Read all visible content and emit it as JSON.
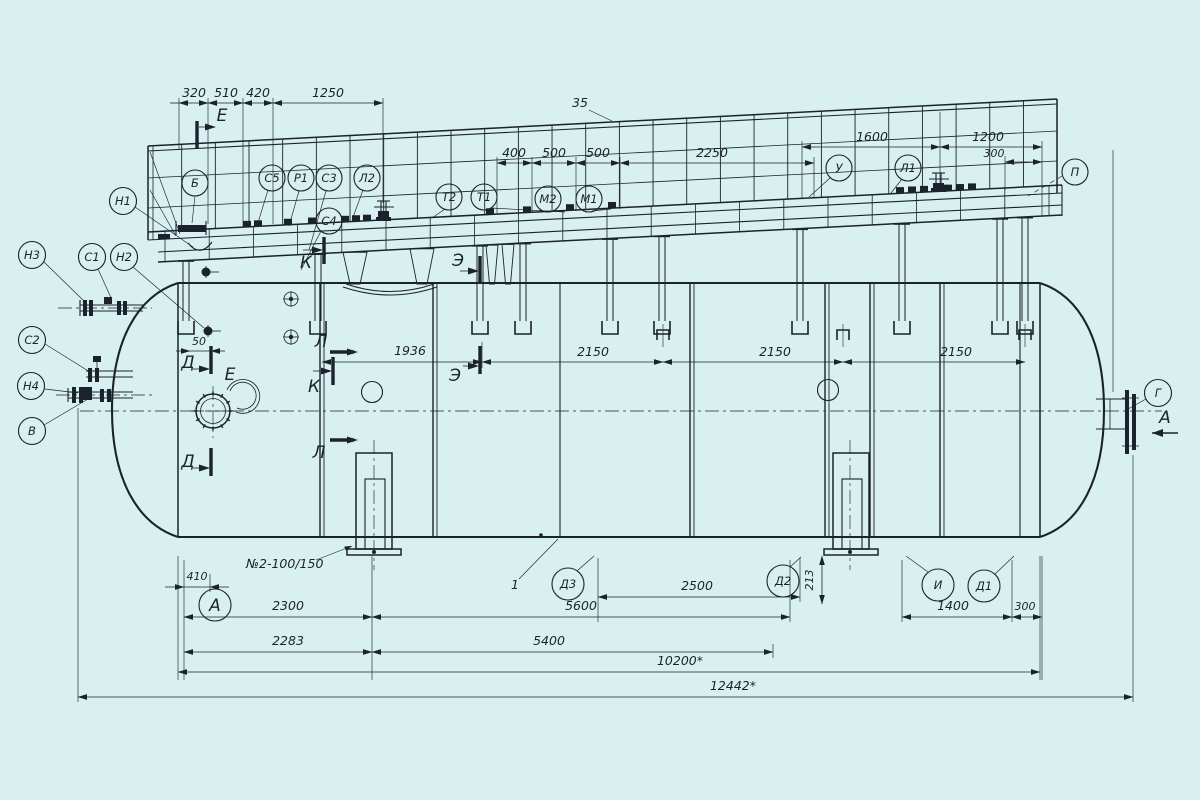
{
  "drawing": {
    "background": "#d8f0ef",
    "ink": "#1c222b",
    "type": "horizontal-vessel-general-arrangement"
  },
  "tags": {
    "platform": [
      "Б",
      "С5",
      "Р1",
      "С3",
      "Л2",
      "С4",
      "Т2",
      "Т1",
      "М2",
      "М1",
      "У",
      "Л1",
      "П"
    ],
    "left": [
      "Н1",
      "Н3",
      "С1",
      "Н2",
      "С2",
      "Н4",
      "В"
    ],
    "bottom": [
      "А",
      "Д3",
      "Д2",
      "И",
      "Д1"
    ],
    "right": [
      "Г"
    ]
  },
  "sections": {
    "e": "Е",
    "d": "Д",
    "k": "К",
    "l": "Л",
    "e2": "Э",
    "detail_e": "Е",
    "view_a": "А"
  },
  "dims": {
    "top_left": [
      "320",
      "510",
      "420",
      "1250"
    ],
    "top_mid": [
      "35",
      "400",
      "500",
      "500",
      "2250"
    ],
    "top_right": [
      "1600",
      "1200",
      "300"
    ],
    "shell": [
      "50",
      "1936",
      "2150",
      "2150",
      "2150"
    ],
    "bottom": [
      "410",
      "2300",
      "2283",
      "5600",
      "5400",
      "2500",
      "213",
      "1400",
      "300",
      "10200*",
      "12442*"
    ]
  },
  "notes": {
    "item_number": "1",
    "support_spec": "№2-100/150"
  }
}
